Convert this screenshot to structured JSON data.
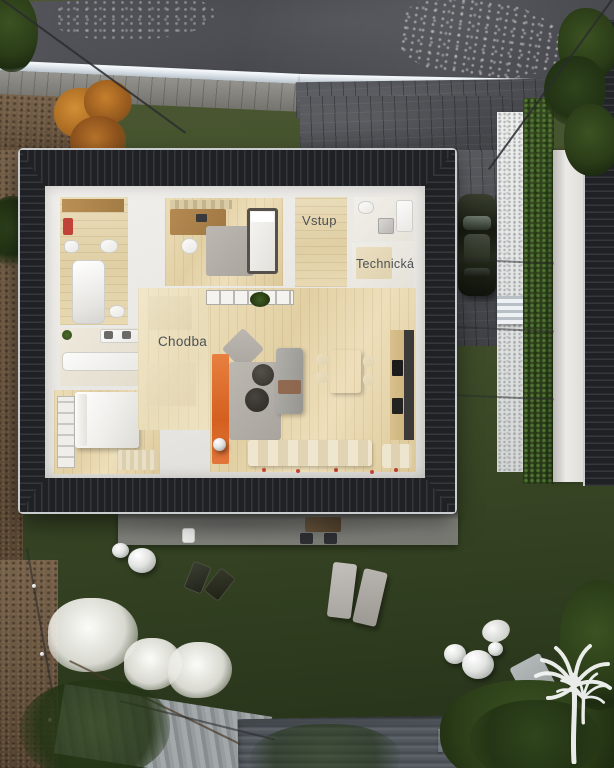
{
  "floor_plan": {
    "labels": {
      "vstup": "Vstup",
      "technicka": "Technická",
      "spajza": "Špajza",
      "chodba": "Chodba"
    }
  },
  "watermark": {
    "text": "NEWLIVING",
    "logo": "palm-trees"
  },
  "palette": {
    "roof": "#26282c",
    "lawn": "#3e4c29",
    "wood_floor": "#e5d4ae",
    "accent_orange": "#dd6f35",
    "label_text": "#4d5156",
    "asphalt": "#4c4d52",
    "mulch": "#6a5743",
    "curb_white": "#e6ebf0",
    "gravel": "#e7e9e7"
  }
}
